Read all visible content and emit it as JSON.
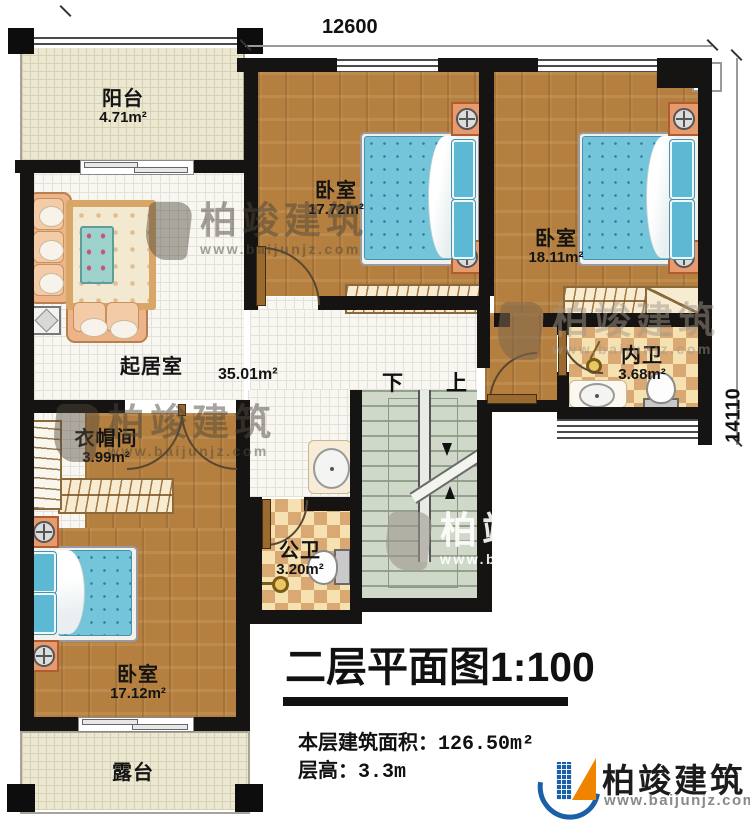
{
  "rooms": {
    "balcony": {
      "name": "阳台",
      "area": "4.71m²"
    },
    "bedroom_top": {
      "name": "卧室",
      "area": "17.72m²"
    },
    "bedroom_right": {
      "name": "卧室",
      "area": "18.11m²"
    },
    "ensuite_bath": {
      "name": "内卫",
      "area": "3.68m²"
    },
    "living_room": {
      "name": "起居室",
      "area": "35.01m²"
    },
    "cloakroom": {
      "name": "衣帽间",
      "area": "3.99m²"
    },
    "public_bath": {
      "name": "公卫",
      "area": "3.20m²"
    },
    "bedroom_bottom": {
      "name": "卧室",
      "area": "17.12m²"
    },
    "terrace": {
      "name": "露台"
    }
  },
  "stairs": {
    "down_label": "下",
    "up_label": "上"
  },
  "dimensions": {
    "width": "12600",
    "height": "14110"
  },
  "title_block": {
    "title": "二层平面图1:100",
    "floor_area_label": "本层建筑面积：",
    "floor_area_value": "126.50m²",
    "floor_height_label": "层高：",
    "floor_height_value": "3.3m"
  },
  "branding": {
    "brand": "柏竣建筑",
    "website": "www.baijunjz.com"
  },
  "colors": {
    "wall": "#161412",
    "wood_floor": "#b5803f",
    "tile_floor": "#f8f7f2",
    "outdoor_floor": "#ebe7d1",
    "checker": "#d9a873",
    "stairs_floor": "#cfd8c9",
    "bed_blue": "#74c4da",
    "nightstand_orange": "#e79a6d",
    "logo_blue": "#1a5fa8",
    "logo_orange": "#f08300"
  }
}
